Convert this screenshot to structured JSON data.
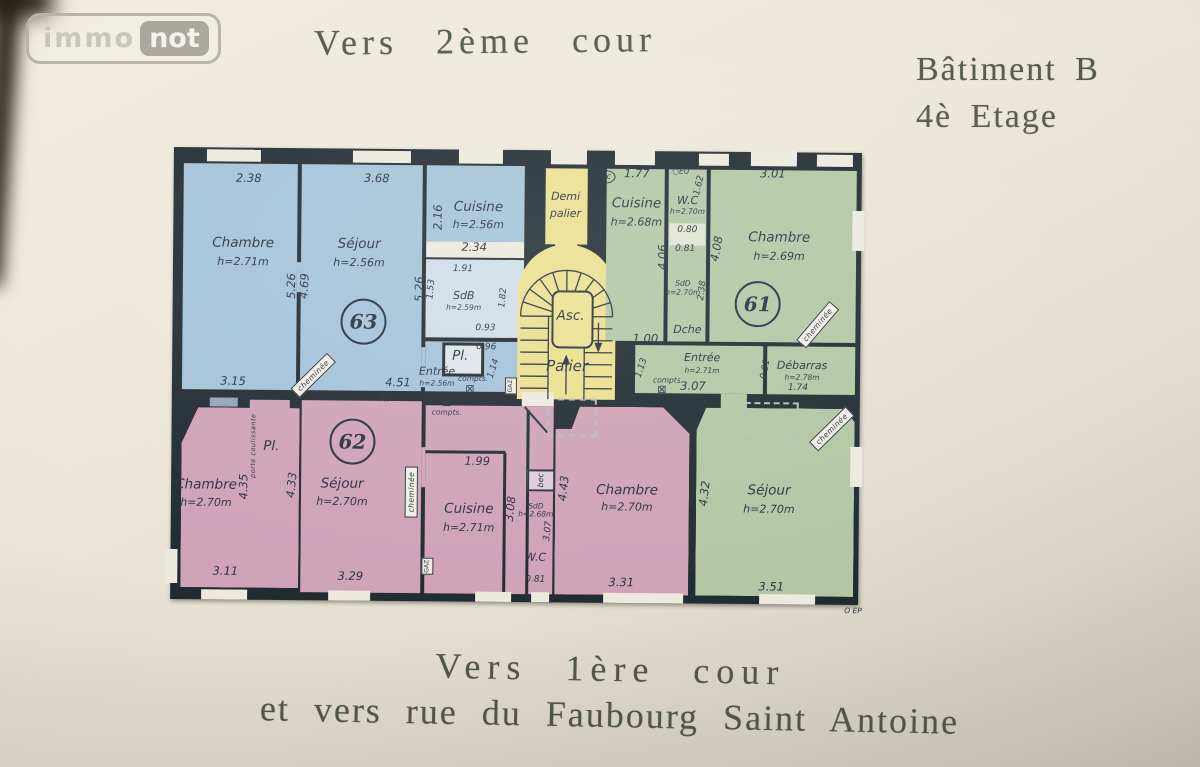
{
  "logo": {
    "immo": "immo",
    "not": "not"
  },
  "header": {
    "top_caption": "Vers 2ème cour",
    "building": "Bâtiment B",
    "floor": "4è Etage"
  },
  "footer": {
    "line1": "Vers 1ère cour",
    "line2": "et vers rue du Faubourg Saint Antoine"
  },
  "colors": {
    "paper": "#ece7da",
    "walls": "#202a31",
    "apartment_63": "#a4c2d8",
    "apartment_61": "#b4c6a4",
    "apartment_62": "#cfa2b6",
    "stairwell": "#ebdf8e",
    "ink": "#273140"
  },
  "plan": {
    "apartments": [
      {
        "number": "63",
        "color_key": "apartment_63"
      },
      {
        "number": "61",
        "color_key": "apartment_61"
      },
      {
        "number": "62",
        "color_key": "apartment_62"
      }
    ],
    "labels": [
      {
        "t": "2.38",
        "x": 82,
        "y": 33,
        "c": "dim"
      },
      {
        "t": "3.68",
        "x": 210,
        "y": 32,
        "c": "dim"
      },
      {
        "t": "2.16",
        "x": 272,
        "y": 70,
        "c": "dim",
        "r": -90
      },
      {
        "t": "Cuisine",
        "x": 312,
        "y": 60,
        "c": "room",
        "n": "room-label-cuisine-63"
      },
      {
        "t": "h=2.56m",
        "x": 312,
        "y": 77,
        "c": "roomh"
      },
      {
        "t": "Chambre",
        "x": 77,
        "y": 98,
        "c": "room",
        "n": "room-label-chambre-63"
      },
      {
        "t": "h=2.71m",
        "x": 77,
        "y": 116,
        "c": "roomh"
      },
      {
        "t": "Séjour",
        "x": 193,
        "y": 98,
        "c": "room",
        "n": "room-label-sejour-63"
      },
      {
        "t": "h=2.56m",
        "x": 193,
        "y": 116,
        "c": "roomh"
      },
      {
        "t": "2.34",
        "x": 308,
        "y": 100,
        "c": "dim"
      },
      {
        "t": "1.91",
        "x": 297,
        "y": 122,
        "c": "dimsm"
      },
      {
        "t": "5.26",
        "x": 126,
        "y": 140,
        "c": "dim",
        "r": -90
      },
      {
        "t": "4.69",
        "x": 139,
        "y": 140,
        "c": "dim",
        "r": -87
      },
      {
        "t": "5.26",
        "x": 254,
        "y": 142,
        "c": "dim",
        "r": -90
      },
      {
        "t": "1.53",
        "x": 266,
        "y": 142,
        "c": "dimsm",
        "r": -85
      },
      {
        "t": "SdB",
        "x": 298,
        "y": 148,
        "c": "roomsm",
        "n": "room-label-sdb-63"
      },
      {
        "t": "h=2.59m",
        "x": 298,
        "y": 160,
        "c": "roomtiny"
      },
      {
        "t": "1.82",
        "x": 338,
        "y": 150,
        "c": "dimsm",
        "r": -85
      },
      {
        "t": "63",
        "x": 198,
        "y": 175,
        "c": "apt",
        "n": "apartment-number-63"
      },
      {
        "t": "0.93",
        "x": 320,
        "y": 181,
        "c": "dimsm"
      },
      {
        "t": "Pl.",
        "x": 295,
        "y": 209,
        "c": "room",
        "n": "room-label-pl-63"
      },
      {
        "t": "0.96",
        "x": 321,
        "y": 200,
        "c": "dimsm"
      },
      {
        "t": "cheminée",
        "x": 148,
        "y": 229,
        "c": "tag",
        "r": -45,
        "n": "cheminee-tag"
      },
      {
        "t": "Entrée",
        "x": 272,
        "y": 224,
        "c": "roomsm",
        "n": "room-label-entree-63"
      },
      {
        "t": "h=2.56m",
        "x": 272,
        "y": 236,
        "c": "roomtiny"
      },
      {
        "t": "1.14",
        "x": 329,
        "y": 221,
        "c": "dimsm",
        "r": -72
      },
      {
        "t": "3.15",
        "x": 68,
        "y": 236,
        "c": "dim"
      },
      {
        "t": "4.51",
        "x": 233,
        "y": 236,
        "c": "dim"
      },
      {
        "t": "compts.",
        "x": 308,
        "y": 231,
        "c": "tiny"
      },
      {
        "t": "⊠",
        "x": 305,
        "y": 241,
        "c": "meter",
        "n": "meter-icon"
      },
      {
        "t": "GAZ",
        "x": 346,
        "y": 238,
        "c": "vtinybox",
        "r": -90,
        "n": "gas-meter-tag"
      },
      {
        "t": "Demi",
        "x": 399,
        "y": 48,
        "c": "roomsm",
        "n": "landing-label-demi-palier"
      },
      {
        "t": "palier",
        "x": 399,
        "y": 65,
        "c": "roomsm"
      },
      {
        "t": "Asc.",
        "x": 405,
        "y": 168,
        "c": "room",
        "n": "elevator-label"
      },
      {
        "t": "Palier",
        "x": 402,
        "y": 218,
        "c": "rooml",
        "n": "landing-label-palier"
      },
      {
        "t": "bec",
        "x": 437,
        "y": 28,
        "c": "oval",
        "n": "bec-tag"
      },
      {
        "t": "1.77",
        "x": 470,
        "y": 25,
        "c": "dim"
      },
      {
        "t": "○EU",
        "x": 514,
        "y": 22,
        "c": "tiny",
        "n": "eu-drain-mark"
      },
      {
        "t": "3.01",
        "x": 606,
        "y": 24,
        "c": "dim"
      },
      {
        "t": "Cuisine",
        "x": 470,
        "y": 55,
        "c": "room",
        "n": "room-label-cuisine-61"
      },
      {
        "t": "h=2.68m",
        "x": 470,
        "y": 73,
        "c": "roomh"
      },
      {
        "t": "W.C",
        "x": 521,
        "y": 51,
        "c": "roomsm",
        "n": "room-label-wc-61"
      },
      {
        "t": "h=2.70m",
        "x": 521,
        "y": 62,
        "c": "roomtiny"
      },
      {
        "t": "1.62",
        "x": 533,
        "y": 36,
        "c": "dimsm",
        "r": -78
      },
      {
        "t": "0.80",
        "x": 521,
        "y": 81,
        "c": "dimsm"
      },
      {
        "t": "0.81",
        "x": 519,
        "y": 100,
        "c": "dimsm"
      },
      {
        "t": "4.08",
        "x": 551,
        "y": 99,
        "c": "dim",
        "r": -80
      },
      {
        "t": "Chambre",
        "x": 613,
        "y": 88,
        "c": "room",
        "n": "room-label-chambre-61"
      },
      {
        "t": "h=2.69m",
        "x": 613,
        "y": 106,
        "c": "roomh"
      },
      {
        "t": "4.06",
        "x": 497,
        "y": 108,
        "c": "dim",
        "r": -90
      },
      {
        "t": "SdD",
        "x": 517,
        "y": 134,
        "c": "roomtiny",
        "n": "room-label-sdd-61"
      },
      {
        "t": "h=2.70m",
        "x": 517,
        "y": 143,
        "c": "roomtiny"
      },
      {
        "t": "2.38",
        "x": 537,
        "y": 141,
        "c": "dimsm",
        "r": -83
      },
      {
        "t": "61",
        "x": 592,
        "y": 154,
        "c": "apt",
        "n": "apartment-number-61"
      },
      {
        "t": "Dche",
        "x": 522,
        "y": 180,
        "c": "roomsm",
        "n": "room-label-dche-61"
      },
      {
        "t": "cheminée",
        "x": 652,
        "y": 174,
        "c": "tag",
        "r": -50,
        "n": "cheminee-tag"
      },
      {
        "t": "1.00",
        "x": 480,
        "y": 190,
        "c": "dim"
      },
      {
        "t": "1.13",
        "x": 477,
        "y": 219,
        "c": "dimsm",
        "r": -72
      },
      {
        "t": "Entrée",
        "x": 537,
        "y": 208,
        "c": "roomsm",
        "n": "room-label-entree-61"
      },
      {
        "t": "h=2.71m",
        "x": 537,
        "y": 221,
        "c": "roomtiny"
      },
      {
        "t": "compts.",
        "x": 503,
        "y": 231,
        "c": "tiny"
      },
      {
        "t": "⊠",
        "x": 497,
        "y": 240,
        "c": "meter",
        "n": "meter-icon"
      },
      {
        "t": "3.07",
        "x": 528,
        "y": 237,
        "c": "dim"
      },
      {
        "t": "0.91",
        "x": 601,
        "y": 219,
        "c": "dimsm",
        "r": -80
      },
      {
        "t": "Débarras",
        "x": 637,
        "y": 215,
        "c": "roomsm",
        "n": "room-label-debarras-61"
      },
      {
        "t": "h=2.78m",
        "x": 637,
        "y": 227,
        "c": "roomtiny"
      },
      {
        "t": "1.74",
        "x": 633,
        "y": 238,
        "c": "dimsm"
      },
      {
        "t": "4.32",
        "x": 541,
        "y": 344,
        "c": "dim",
        "r": -84
      },
      {
        "t": "Séjour",
        "x": 605,
        "y": 341,
        "c": "room",
        "n": "room-label-sejour-61"
      },
      {
        "t": "h=2.70m",
        "x": 605,
        "y": 359,
        "c": "roomh"
      },
      {
        "t": "3.51",
        "x": 608,
        "y": 437,
        "c": "dim"
      },
      {
        "t": "cheminée",
        "x": 667,
        "y": 278,
        "c": "tag",
        "r": -45,
        "n": "cheminee-tag"
      },
      {
        "t": "Pl.",
        "x": 219,
        "y": 253,
        "c": "dimsm"
      },
      {
        "t": "⊠",
        "x": 282,
        "y": 255,
        "c": "meter",
        "n": "meter-icon"
      },
      {
        "t": "compts.",
        "x": 282,
        "y": 265,
        "c": "tiny"
      },
      {
        "t": "62",
        "x": 188,
        "y": 295,
        "c": "apt",
        "n": "apartment-number-62"
      },
      {
        "t": "Pl.",
        "x": 107,
        "y": 301,
        "c": "room",
        "n": "room-label-pl-62"
      },
      {
        "t": "porte coulissante",
        "x": 89,
        "y": 300,
        "c": "vtiny",
        "r": -90,
        "n": "sliding-door-note"
      },
      {
        "t": "Chambre",
        "x": 42,
        "y": 340,
        "c": "room",
        "n": "room-label-chambre-62"
      },
      {
        "t": "h=2.70m",
        "x": 42,
        "y": 357,
        "c": "roomh"
      },
      {
        "t": "4.35",
        "x": 80,
        "y": 341,
        "c": "dim",
        "r": -90
      },
      {
        "t": "4.33",
        "x": 128,
        "y": 339,
        "c": "dim",
        "r": -85
      },
      {
        "t": "Séjour",
        "x": 178,
        "y": 338,
        "c": "room",
        "n": "room-label-sejour-62"
      },
      {
        "t": "h=2.70m",
        "x": 178,
        "y": 355,
        "c": "roomh"
      },
      {
        "t": "cheminée",
        "x": 247,
        "y": 345,
        "c": "tag",
        "r": -90,
        "n": "cheminee-tag"
      },
      {
        "t": "3.11",
        "x": 62,
        "y": 426,
        "c": "dim"
      },
      {
        "t": "3.29",
        "x": 187,
        "y": 430,
        "c": "dim"
      },
      {
        "t": "1.99",
        "x": 313,
        "y": 314,
        "c": "dim"
      },
      {
        "t": "Cuisine",
        "x": 305,
        "y": 362,
        "c": "room",
        "n": "room-label-cuisine-62"
      },
      {
        "t": "h=2.71m",
        "x": 305,
        "y": 380,
        "c": "roomh"
      },
      {
        "t": "3.08",
        "x": 347,
        "y": 361,
        "c": "dim",
        "r": -84
      },
      {
        "t": "bec",
        "x": 377,
        "y": 332,
        "c": "vbox",
        "r": -90,
        "n": "bec-tag"
      },
      {
        "t": "SdD",
        "x": 372,
        "y": 358,
        "c": "roomtiny",
        "n": "room-label-sdd-62"
      },
      {
        "t": "h=2.68m",
        "x": 372,
        "y": 366,
        "c": "roomtiny"
      },
      {
        "t": "3.07",
        "x": 385,
        "y": 383,
        "c": "dimsm",
        "r": -84
      },
      {
        "t": "4.43",
        "x": 400,
        "y": 340,
        "c": "dim",
        "r": -84
      },
      {
        "t": "W.C",
        "x": 372,
        "y": 409,
        "c": "roomsm",
        "n": "room-label-wc-62"
      },
      {
        "t": "0.81",
        "x": 372,
        "y": 432,
        "c": "dimsm"
      },
      {
        "t": "GAZ",
        "x": 264,
        "y": 419,
        "c": "vtinybox",
        "r": -90,
        "n": "gas-meter-tag"
      },
      {
        "t": "Chambre",
        "x": 463,
        "y": 342,
        "c": "room",
        "n": "room-label-chambre-62b"
      },
      {
        "t": "h=2.70m",
        "x": 463,
        "y": 358,
        "c": "roomh"
      },
      {
        "t": "3.31",
        "x": 458,
        "y": 434,
        "c": "dim"
      },
      {
        "t": "O EP",
        "x": 690,
        "y": 460,
        "c": "tiny",
        "n": "ep-annotation"
      }
    ]
  }
}
